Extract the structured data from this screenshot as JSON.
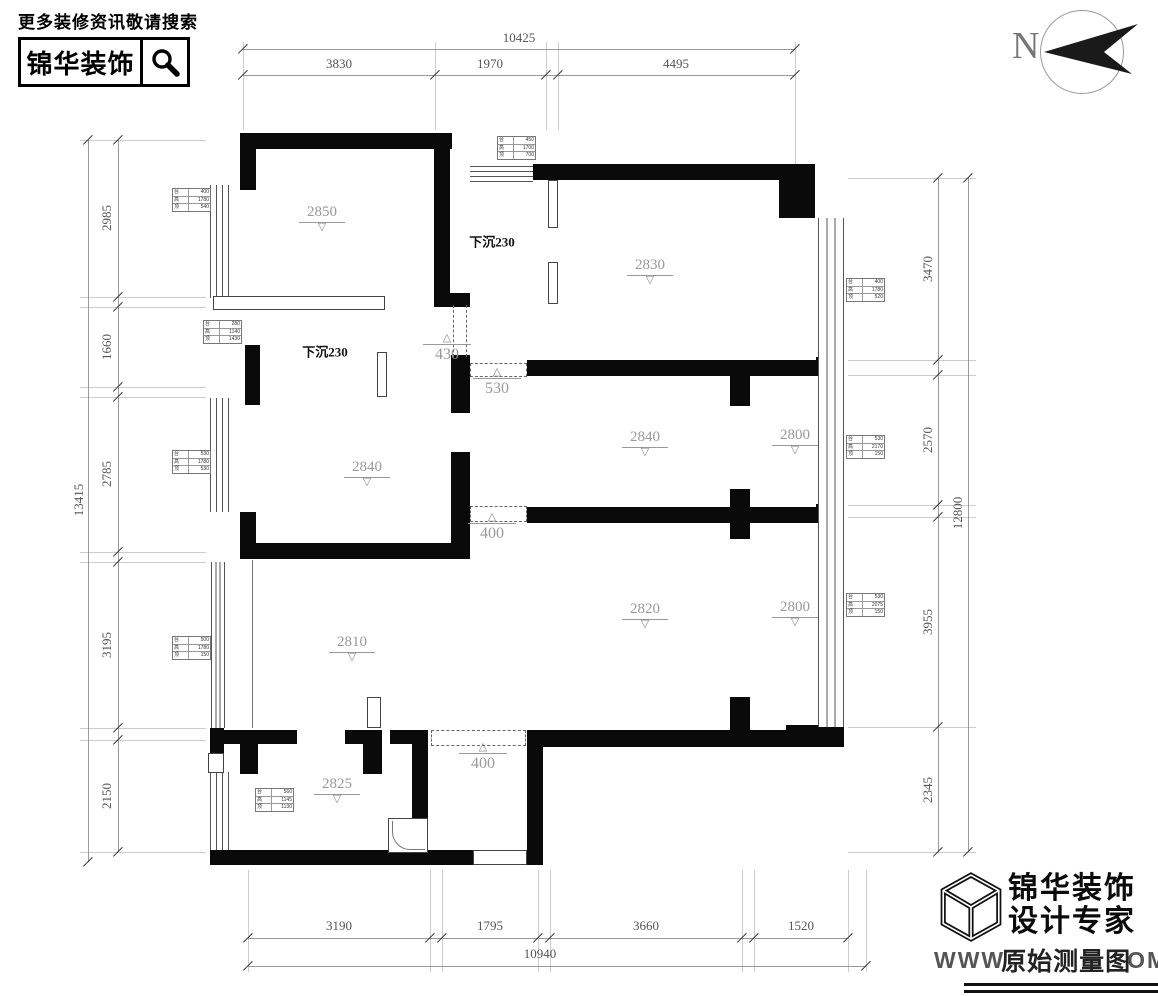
{
  "header": {
    "tagline": "更多装修资讯敬请搜索",
    "brand": "锦华装饰",
    "search_icon": "magnifier-icon"
  },
  "compass": {
    "label": "N"
  },
  "footer": {
    "brand": "锦华装饰",
    "subtitle": "设计专家",
    "url_left": "WWW",
    "watermark": "原始测量图",
    "url_right": "OM",
    "logo": "cube-icon"
  },
  "dims": [
    {
      "orient": "h",
      "pos": 49,
      "a": 243,
      "b": 795,
      "ticks": [
        243,
        795
      ],
      "labels": [
        {
          "t": "10425",
          "x": 519,
          "y": 38
        }
      ]
    },
    {
      "orient": "h",
      "pos": 75,
      "a": 243,
      "b": 795,
      "ticks": [
        243,
        435,
        546,
        558,
        795
      ],
      "labels": [
        {
          "t": "3830",
          "x": 339,
          "y": 64
        },
        {
          "t": "1970",
          "x": 490,
          "y": 64
        },
        {
          "t": "4495",
          "x": 676,
          "y": 64
        }
      ]
    },
    {
      "orient": "v",
      "pos": 88,
      "a": 140,
      "b": 862,
      "ticks": [
        140,
        862
      ],
      "labels": [
        {
          "t": "13415",
          "x": 79,
          "y": 500,
          "rot": 1
        }
      ]
    },
    {
      "orient": "v",
      "pos": 118,
      "a": 140,
      "b": 852,
      "ticks": [
        140,
        297,
        307,
        387,
        397,
        552,
        562,
        728,
        740,
        852
      ],
      "labels": [
        {
          "t": "2985",
          "x": 107,
          "y": 218,
          "rot": 1
        },
        {
          "t": "1660",
          "x": 107,
          "y": 347,
          "rot": 1
        },
        {
          "t": "2785",
          "x": 107,
          "y": 474,
          "rot": 1
        },
        {
          "t": "3195",
          "x": 107,
          "y": 645,
          "rot": 1
        },
        {
          "t": "2150",
          "x": 107,
          "y": 796,
          "rot": 1
        }
      ]
    },
    {
      "orient": "v",
      "pos": 938,
      "a": 178,
      "b": 852,
      "ticks": [
        178,
        360,
        375,
        505,
        517,
        727,
        852
      ],
      "labels": [
        {
          "t": "3470",
          "x": 928,
          "y": 269,
          "rot": 1
        },
        {
          "t": "2570",
          "x": 928,
          "y": 440,
          "rot": 1
        },
        {
          "t": "3955",
          "x": 928,
          "y": 622,
          "rot": 1
        },
        {
          "t": "2345",
          "x": 928,
          "y": 790,
          "rot": 1
        }
      ]
    },
    {
      "orient": "v",
      "pos": 968,
      "a": 178,
      "b": 852,
      "ticks": [
        178,
        852
      ],
      "labels": [
        {
          "t": "12800",
          "x": 958,
          "y": 513,
          "rot": 1
        }
      ]
    },
    {
      "orient": "h",
      "pos": 938,
      "a": 248,
      "b": 848,
      "ticks": [
        248,
        430,
        442,
        538,
        550,
        742,
        754,
        848
      ],
      "labels": [
        {
          "t": "3190",
          "x": 339,
          "y": 926
        },
        {
          "t": "1795",
          "x": 490,
          "y": 926
        },
        {
          "t": "3660",
          "x": 646,
          "y": 926
        },
        {
          "t": "1520",
          "x": 801,
          "y": 926
        }
      ]
    },
    {
      "orient": "h",
      "pos": 966,
      "a": 248,
      "b": 866,
      "ticks": [
        248,
        866
      ],
      "labels": [
        {
          "t": "10940",
          "x": 540,
          "y": 954
        }
      ]
    }
  ],
  "extensions": [
    {
      "orient": "v",
      "at": [
        243,
        435,
        546,
        558,
        795
      ],
      "a": 42,
      "b": 130
    },
    {
      "orient": "v",
      "at": [
        795
      ],
      "a": 130,
      "b": 164
    },
    {
      "orient": "h",
      "at": [
        140,
        297,
        307,
        387,
        397,
        552,
        562,
        728,
        740,
        852
      ],
      "a": 80,
      "b": 206
    },
    {
      "orient": "h",
      "at": [
        178,
        360,
        375,
        505,
        517,
        727,
        852
      ],
      "a": 848,
      "b": 976
    },
    {
      "orient": "v",
      "at": [
        248,
        430,
        442,
        538,
        550,
        742,
        754,
        848,
        866
      ],
      "a": 870,
      "b": 972
    }
  ],
  "plan": {
    "walls": [
      [
        240,
        133,
        212,
        16
      ],
      [
        240,
        133,
        16,
        57
      ],
      [
        434,
        133,
        16,
        170
      ],
      [
        434,
        293,
        36,
        14
      ],
      [
        533,
        164,
        262,
        16
      ],
      [
        779,
        164,
        36,
        54
      ],
      [
        816,
        357,
        28,
        18
      ],
      [
        816,
        504,
        28,
        16
      ],
      [
        786,
        725,
        58,
        22
      ],
      [
        527,
        360,
        300,
        16
      ],
      [
        730,
        376,
        20,
        30
      ],
      [
        451,
        355,
        19,
        58
      ],
      [
        451,
        452,
        19,
        107
      ],
      [
        240,
        543,
        230,
        16
      ],
      [
        240,
        512,
        16,
        47
      ],
      [
        527,
        507,
        300,
        16
      ],
      [
        730,
        489,
        20,
        50
      ],
      [
        527,
        730,
        317,
        17
      ],
      [
        730,
        697,
        20,
        33
      ],
      [
        527,
        745,
        16,
        120
      ],
      [
        412,
        730,
        16,
        125
      ],
      [
        390,
        730,
        38,
        14
      ],
      [
        212,
        730,
        85,
        14
      ],
      [
        240,
        742,
        18,
        32
      ],
      [
        345,
        730,
        37,
        14
      ],
      [
        363,
        742,
        19,
        32
      ],
      [
        247,
        850,
        226,
        15
      ],
      [
        210,
        850,
        37,
        15
      ],
      [
        210,
        728,
        14,
        44
      ],
      [
        245,
        345,
        15,
        60
      ]
    ],
    "windows_v": [
      [
        210,
        185,
        17,
        113
      ],
      [
        210,
        398,
        17,
        114
      ],
      [
        211,
        562,
        12,
        166
      ],
      [
        210,
        772,
        17,
        78
      ],
      [
        818,
        218,
        24,
        509
      ]
    ],
    "windows_h": [
      [
        470,
        166,
        63,
        14
      ]
    ],
    "thin": [
      [
        213,
        296,
        172,
        14
      ],
      [
        548,
        180,
        10,
        48
      ],
      [
        548,
        262,
        10,
        42
      ],
      [
        377,
        352,
        10,
        45
      ],
      [
        367,
        697,
        14,
        31
      ],
      [
        208,
        753,
        16,
        20
      ],
      [
        388,
        818,
        40,
        35
      ],
      [
        473,
        850,
        54,
        15
      ]
    ],
    "arc": [
      392,
      821,
      33,
      29
    ],
    "hair": [
      [
        252,
        560,
        1,
        168
      ]
    ],
    "dash_full": [
      [
        470,
        363,
        57,
        14
      ],
      [
        470,
        506,
        57,
        16
      ],
      [
        431,
        730,
        95,
        16
      ]
    ],
    "dash_v2": [
      [
        453,
        305,
        14,
        52
      ]
    ],
    "levels": [
      {
        "v": "2850",
        "x": 322,
        "y": 205
      },
      {
        "v": "2830",
        "x": 650,
        "y": 258
      },
      {
        "v": "2840",
        "x": 645,
        "y": 430
      },
      {
        "v": "2800",
        "x": 795,
        "y": 428
      },
      {
        "v": "2840",
        "x": 367,
        "y": 460
      },
      {
        "v": "2800",
        "x": 795,
        "y": 600
      },
      {
        "v": "2820",
        "x": 645,
        "y": 602
      },
      {
        "v": "2810",
        "x": 352,
        "y": 635
      },
      {
        "v": "2825",
        "x": 337,
        "y": 777
      }
    ],
    "openings": [
      {
        "v": "430",
        "x": 447,
        "y": 333
      },
      {
        "v": "530",
        "x": 497,
        "y": 367
      },
      {
        "v": "400",
        "x": 492,
        "y": 512
      },
      {
        "v": "400",
        "x": 483,
        "y": 742
      }
    ],
    "sunken": [
      {
        "t": "下沉230",
        "x": 492,
        "y": 241
      },
      {
        "t": "下沉230",
        "x": 325,
        "y": 351
      }
    ],
    "tags": [
      {
        "x": 497,
        "y": 136,
        "rows": [
          [
            "台",
            "450"
          ],
          [
            "高",
            "1700"
          ],
          [
            "顶",
            "700"
          ]
        ]
      },
      {
        "x": 172,
        "y": 188,
        "rows": [
          [
            "台",
            "400"
          ],
          [
            "高",
            "1780"
          ],
          [
            "顶",
            "540"
          ]
        ]
      },
      {
        "x": 203,
        "y": 320,
        "rows": [
          [
            "台",
            "280"
          ],
          [
            "高",
            "1140"
          ],
          [
            "顶",
            "1430"
          ]
        ]
      },
      {
        "x": 172,
        "y": 450,
        "rows": [
          [
            "台",
            "530"
          ],
          [
            "高",
            "1780"
          ],
          [
            "顶",
            "530"
          ]
        ]
      },
      {
        "x": 172,
        "y": 636,
        "rows": [
          [
            "台",
            "500"
          ],
          [
            "高",
            "1780"
          ],
          [
            "顶",
            "150"
          ]
        ]
      },
      {
        "x": 846,
        "y": 278,
        "rows": [
          [
            "台",
            "400"
          ],
          [
            "高",
            "1780"
          ],
          [
            "顶",
            "520"
          ]
        ]
      },
      {
        "x": 846,
        "y": 435,
        "rows": [
          [
            "台",
            "530"
          ],
          [
            "高",
            "2170"
          ],
          [
            "顶",
            "150"
          ]
        ]
      },
      {
        "x": 846,
        "y": 593,
        "rows": [
          [
            "台",
            "530"
          ],
          [
            "高",
            "2075"
          ],
          [
            "顶",
            "150"
          ]
        ]
      },
      {
        "x": 255,
        "y": 788,
        "rows": [
          [
            "台",
            "560"
          ],
          [
            "高",
            "1145"
          ],
          [
            "顶",
            "1130"
          ]
        ]
      }
    ]
  }
}
